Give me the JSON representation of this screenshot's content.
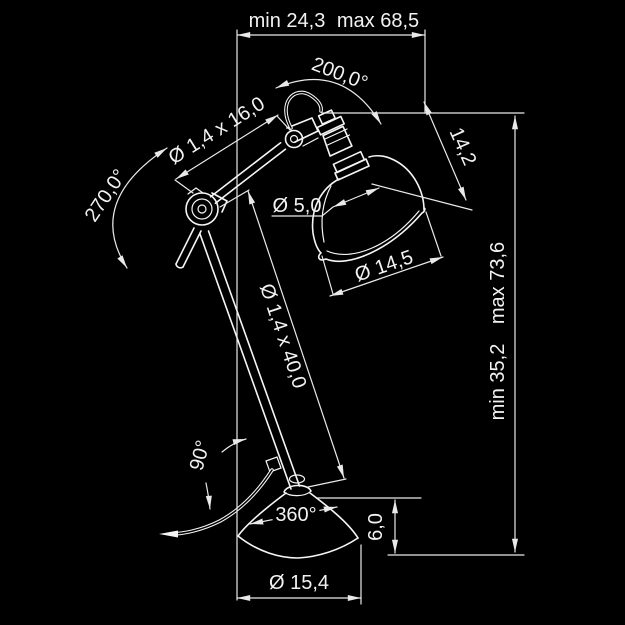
{
  "colors": {
    "background": "#000000",
    "drawing_line": "#f5f5f5",
    "dimension_line": "#e9e9e9",
    "text": "#f2f2f2"
  },
  "labels": {
    "width_min": "min 24,3",
    "width_max": "max 68,5",
    "height_min": "min 35,2",
    "height_max": "max 73,6",
    "shade_swivel_angle": "200,0°",
    "elbow_angle": "270,0°",
    "upper_arm_size": "Ø 1,4 x 16,0",
    "lower_arm_size": "Ø 1,4 x 40,0",
    "socket_diameter": "Ø 5,0",
    "shade_height": "14,2",
    "shade_diameter": "Ø 14,5",
    "cable_angle": "90°",
    "base_rotation": "360°",
    "base_height": "6,0",
    "base_diameter": "Ø 15,4"
  }
}
